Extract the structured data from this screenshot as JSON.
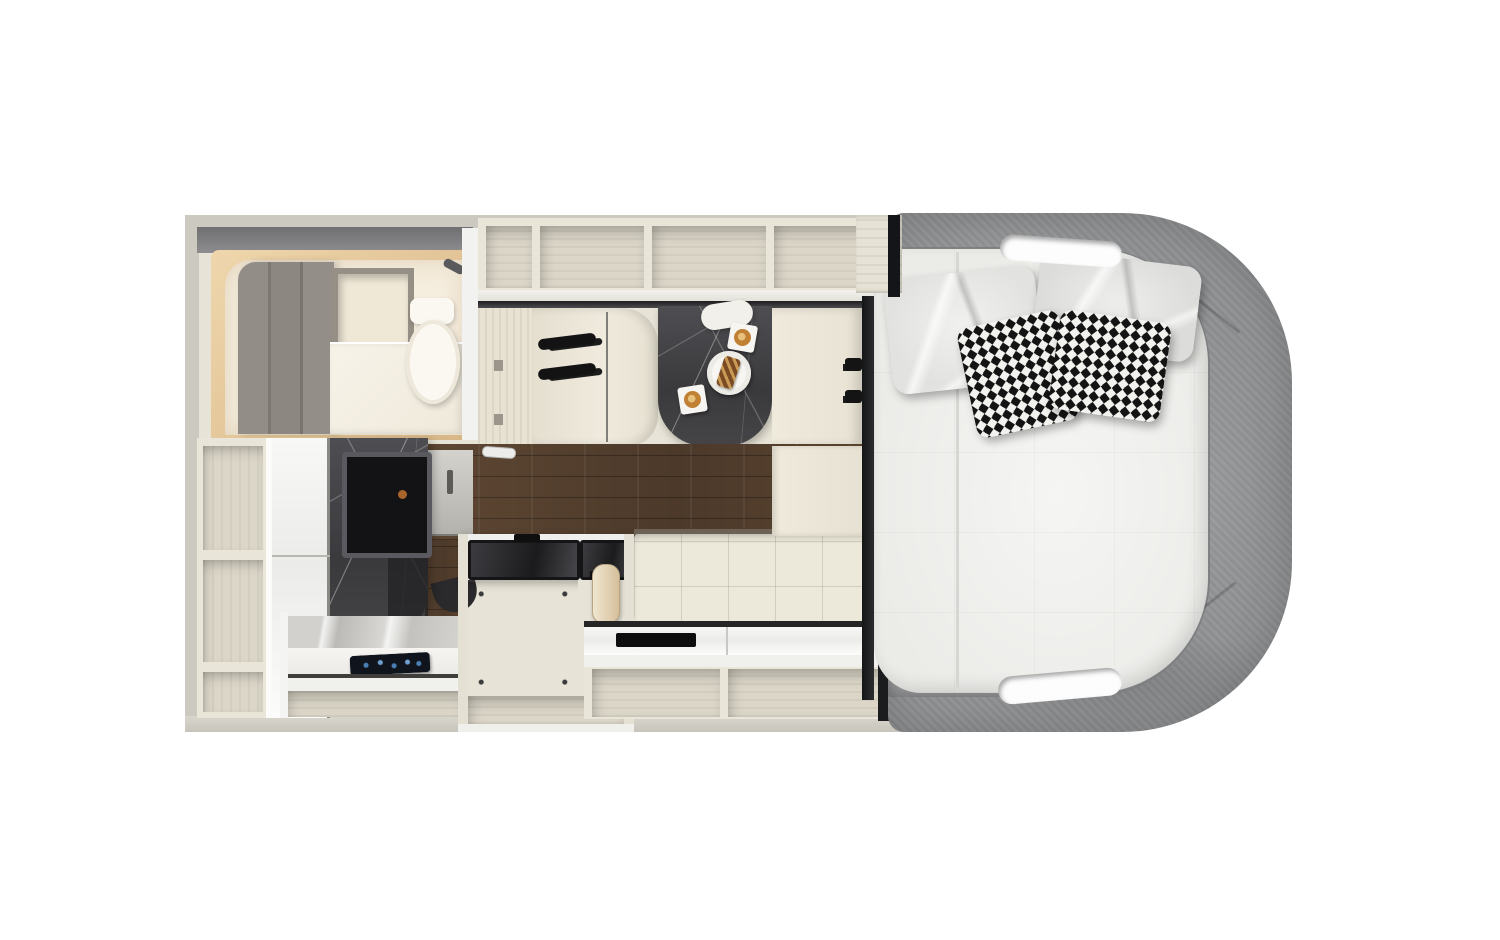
{
  "scene": {
    "title": "Motorhome interior floor plan, top-down 3D render",
    "view": "top-down",
    "visible_text": "none"
  },
  "palette": {
    "bg": "#ffffff",
    "wall": "#ccc9c0",
    "interior": "#e7e3d6",
    "cream": "#e9e5d8",
    "shelfInterior": "#dbd6c8",
    "woodDark": "#57412f",
    "marbleDark": "#3e3e41",
    "feltGray": "#8f9193",
    "feltGrayDark": "#77787a",
    "mattress": "#ebebe8",
    "pillowWhite": "#e2e2e0",
    "sofaCream": "#ece8da",
    "applianceBlack": "#202022",
    "bathWarm": "#f5edde",
    "bathGlow": "#e5cda6",
    "bathPanelGray": "#8d8782",
    "toiletWhite": "#fbf8f2",
    "coffee": "#c08134",
    "pastryBrown": "#7a4a22",
    "screenBlue": "#4a7fb5",
    "trackDark": "#232325"
  },
  "regions": [
    {
      "id": "exterior-wall",
      "label": "RV body outer wall"
    },
    {
      "id": "wet-bath",
      "label": "Wet bath with mirror panels, niche, vanity and toilet"
    },
    {
      "id": "tall-shelving",
      "label": "Tall open shelving column, 3 compartments"
    },
    {
      "id": "wardrobe",
      "label": "Glossy white wardrobe"
    },
    {
      "id": "shower",
      "label": "Dark marble shower column with TV panel"
    },
    {
      "id": "overhead-cabinets",
      "label": "Overhead cabinet row, 4 open compartments"
    },
    {
      "id": "dinette",
      "label": "Dinette with two bench seats and grab handles"
    },
    {
      "id": "dinette-table",
      "label": "Dark marble table"
    },
    {
      "id": "table-items",
      "label": "Two cappuccino cups on square saucers, round plate with pastry",
      "coffee_cups": 2,
      "plates": 1
    },
    {
      "id": "galley-floor",
      "label": "Dark wood plank galley floor"
    },
    {
      "id": "kitchen-block",
      "label": "Kitchen island with two dark glass cooktop/sink lids"
    },
    {
      "id": "refrigerator",
      "label": "Black refrigerator / appliance front"
    },
    {
      "id": "kettle",
      "label": "Beige kettle on counter"
    },
    {
      "id": "sofa",
      "label": "Tufted cream sofa bench"
    },
    {
      "id": "ledge",
      "label": "White ledge with black vent slot"
    },
    {
      "id": "under-storage",
      "label": "Open storage cubbies along lower wall"
    },
    {
      "id": "control-tablet",
      "label": "Dark control tablet / induction panel with blue glow"
    },
    {
      "id": "bed",
      "label": "Island bed mattress",
      "white_pillows": 2,
      "houndstooth_pillows": 2
    },
    {
      "id": "cab-wrap",
      "label": "Gray felt cab surround with two cutout slots",
      "cutouts": 2
    }
  ]
}
